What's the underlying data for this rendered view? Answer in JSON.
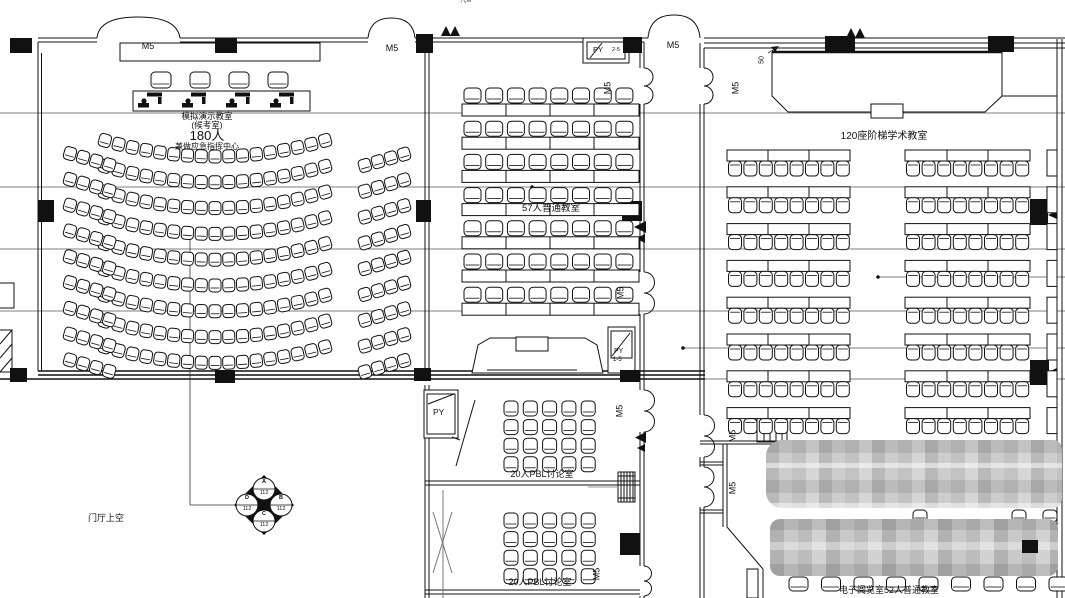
{
  "labels": {
    "hall_room_line1": "模拟演示教室",
    "hall_room_line2": "(候考室)",
    "hall_room_line3": "180人",
    "hall_room_line4": "兼做应急指挥中心",
    "classroom_57": "57人普通教室",
    "classroom_120": "120座阶梯学术教室",
    "pbl_room_1": "20人PBL讨论室",
    "pbl_room_2": "20人PBL讨论室",
    "reading_room": "电子阅览室52人普通教室",
    "foyer_void": "门厅上空",
    "top_edge_partial": "凡M",
    "dim_50": "50"
  },
  "door_label": "M5",
  "vent_labels": {
    "py": "PY",
    "py_range_top": "2-5",
    "py_range_mid": "1-5"
  },
  "elevation_symbol": {
    "top": {
      "letter": "A",
      "value": "112"
    },
    "right": {
      "letter": "B",
      "value": "112"
    },
    "bottom": {
      "letter": "C",
      "value": "112"
    },
    "left": {
      "letter": "D",
      "value": "112"
    }
  },
  "seating": {
    "hall_center": {
      "rows": 9,
      "cols": 17
    },
    "hall_wing": {
      "rows": 9,
      "cols": 4
    },
    "judges": {
      "chairs": 4,
      "workstations": 4
    },
    "room57": {
      "rows": 7,
      "cols": 8
    },
    "room120": {
      "rows": 8,
      "cols": 8,
      "groups": 2
    },
    "pbl": {
      "rows": 4,
      "cols": 5,
      "rooms": 2
    },
    "reading": {
      "bottom": 9,
      "gap": 3
    }
  },
  "colors": {
    "line": "#111111",
    "datum": "#555555",
    "blur_base": "#c6c6c6"
  }
}
